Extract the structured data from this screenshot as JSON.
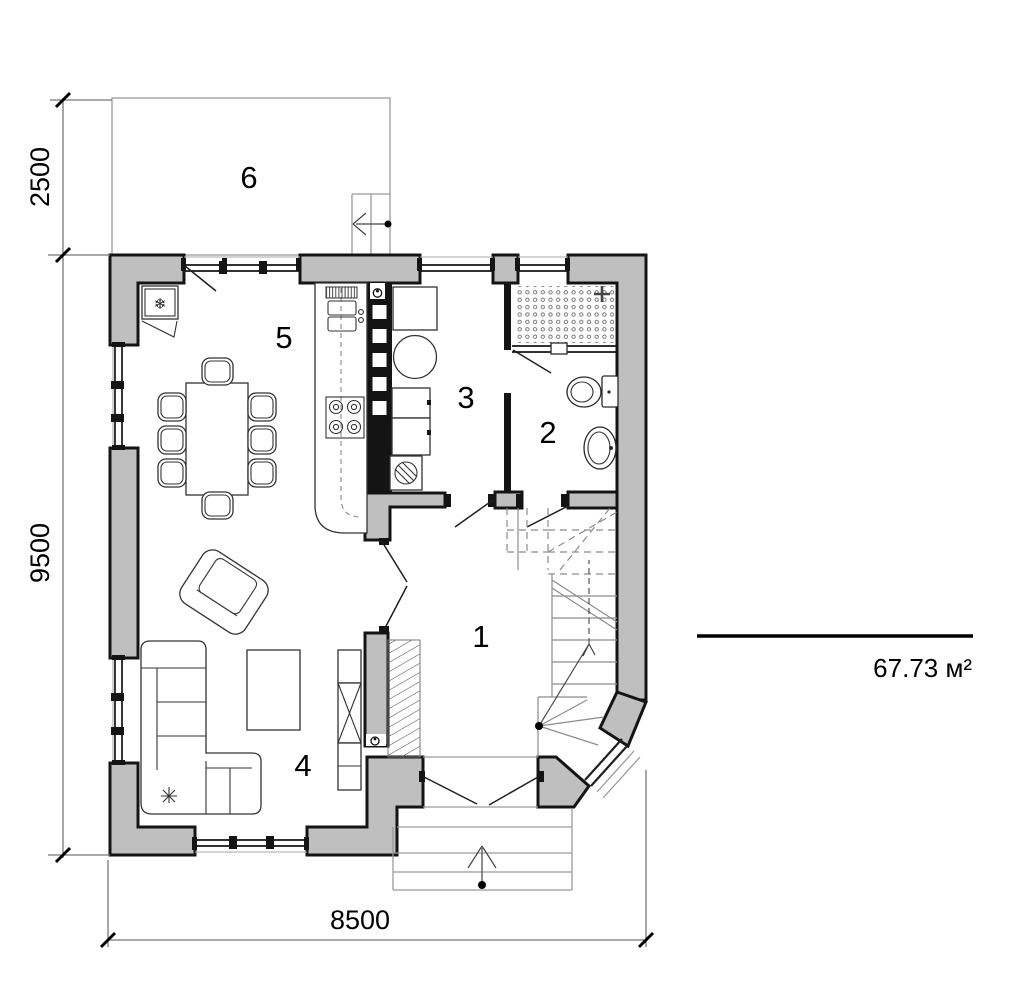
{
  "colors": {
    "wall_fill": "#bfbfbf",
    "outline": "#141414",
    "thin_line": "#9a9a9a",
    "stair_line": "#8c8c8c",
    "dim_line": "#777777",
    "text": "#000000"
  },
  "rooms": {
    "r1": {
      "label": "1"
    },
    "r2": {
      "label": "2"
    },
    "r3": {
      "label": "3"
    },
    "r4": {
      "label": "4"
    },
    "r5": {
      "label": "5"
    },
    "r6": {
      "label": "6"
    }
  },
  "dimensions": {
    "terrace_depth": "2500",
    "house_depth": "9500",
    "house_width": "8500"
  },
  "area": {
    "total": "67.73 м²"
  },
  "symbols": {
    "fridge_snowflake": "❄"
  }
}
